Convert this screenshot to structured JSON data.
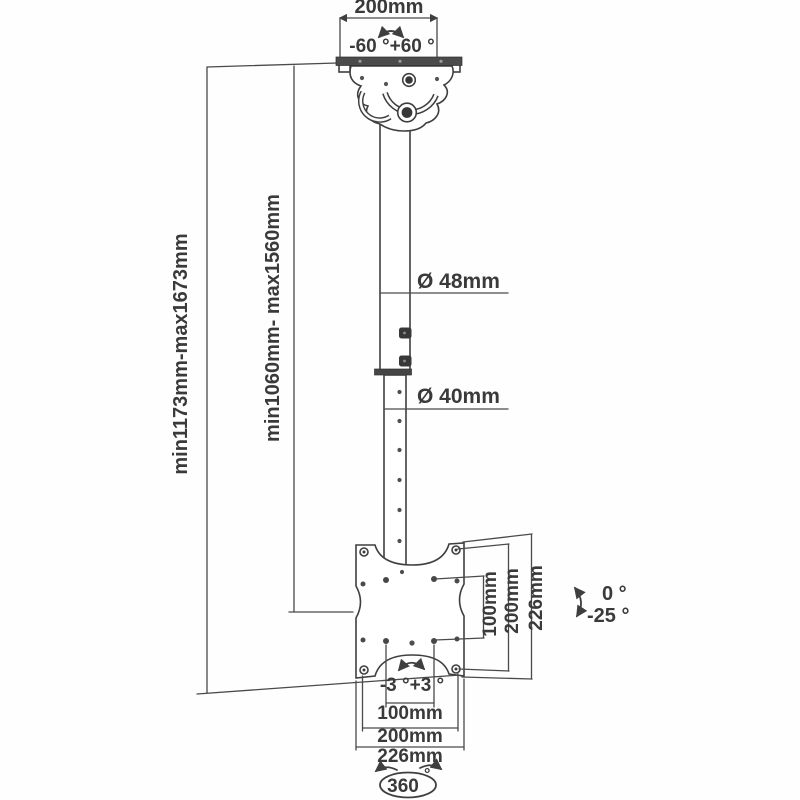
{
  "title": "TV ceiling mount dimension diagram",
  "colors": {
    "line": "#3f3f3f",
    "dim_line": "#4a4a4a",
    "text": "#3a3a3a",
    "metal_dark": "#4b4b4b",
    "background": "#fefefe"
  },
  "top": {
    "width": "200mm",
    "swivel_range": "-60 °+60 °"
  },
  "left": {
    "overall_height": "min1173mm-max1673mm",
    "pole_height": "min1060mm- max1560mm"
  },
  "pole": {
    "upper_diameter": "Ø 48mm",
    "lower_diameter": "Ø 40mm"
  },
  "plate_right": {
    "vesa_height": "100mm",
    "hole_height": "200mm",
    "plate_height": "226mm"
  },
  "plate_bottom": {
    "vesa_width": "100mm",
    "hole_width": "200mm",
    "plate_width": "226mm",
    "level_range": "-3 °+3 °"
  },
  "tilt": {
    "up": "0 °",
    "down": "-25 °"
  },
  "rotation": {
    "value": "360",
    "degree": "°"
  }
}
